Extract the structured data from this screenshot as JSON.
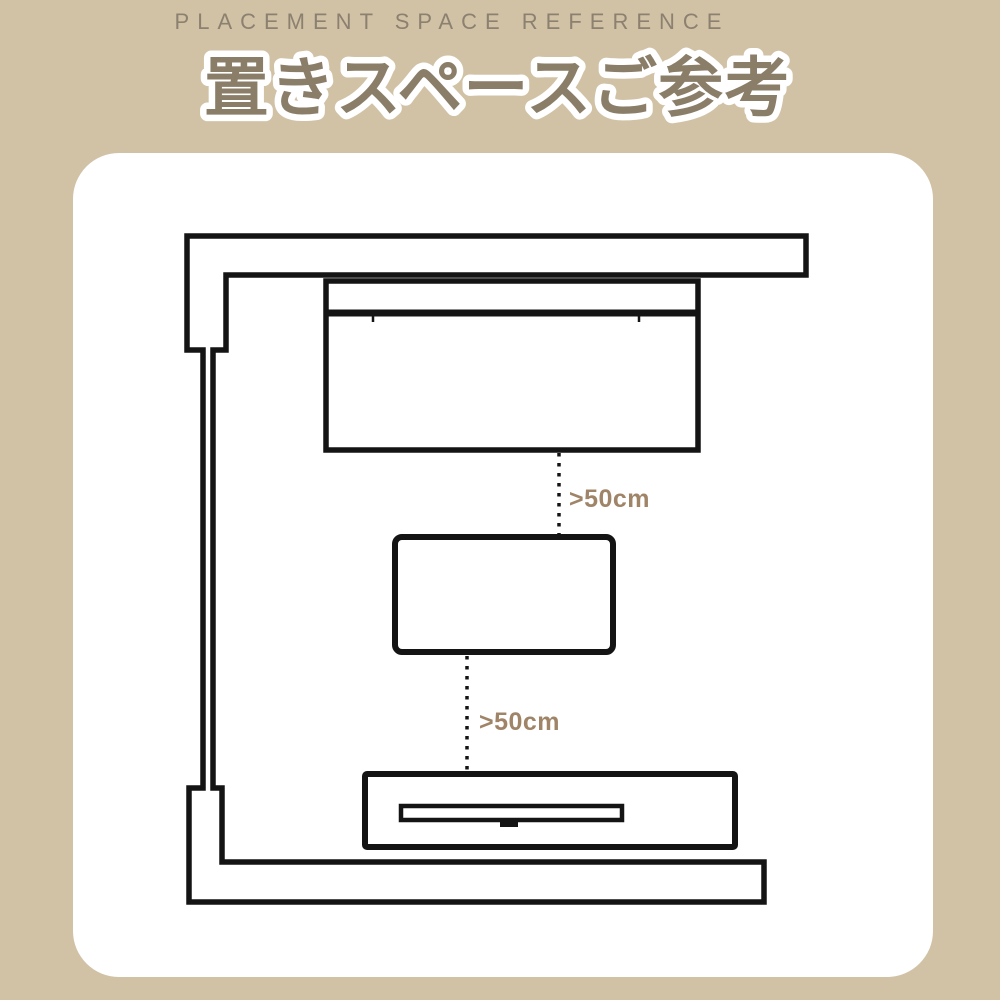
{
  "header": {
    "eyebrow": "PLACEMENT SPACE REFERENCE",
    "title": "置きスペースご参考"
  },
  "diagram": {
    "gap_labels": {
      "top": ">50cm",
      "bottom": ">50cm"
    },
    "icons": [
      "room-walls",
      "sofa",
      "table",
      "tv-stand",
      "tv"
    ]
  },
  "colors": {
    "background": "#d1c2a6",
    "card": "#ffffff",
    "title_fill": "#8b7e69",
    "title_outline": "#ffffff",
    "eyebrow_text": "#8c8170",
    "gap_label_text": "#a08468",
    "diagram_line": "#141414"
  }
}
